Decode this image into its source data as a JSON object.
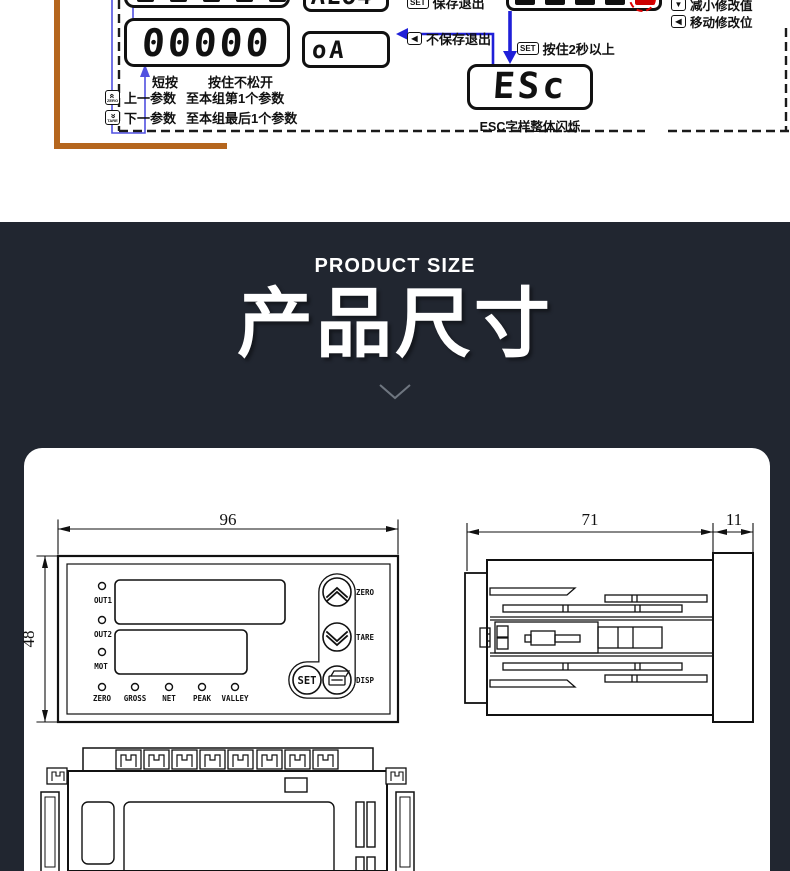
{
  "diagram": {
    "display_main": "00000",
    "display_or": "oA",
    "display_esc": "ESc",
    "display_partial_top": "ALo4",
    "set_key": "SET",
    "save_exit": "保存退出",
    "no_save_exit": "不保存退出",
    "set_hold": "按住2秒以上",
    "esc_blink_note": "ESC字样整体闪烁",
    "decrease_value": "减小修改值",
    "move_digit": "移动修改位",
    "short_press": "短按",
    "hold_press": "按住不松开",
    "prev_param": "上一参数",
    "prev_param_target": "至本组第1个参数",
    "next_param": "下一参数",
    "next_param_target": "至本组最后1个参数",
    "zero_key_label": "ZERO",
    "tare_key_label": "TARE"
  },
  "banner": {
    "subtitle": "PRODUCT SIZE",
    "title": "产品尺寸"
  },
  "drawings": {
    "front": {
      "width_dim": "96",
      "height_dim": "48",
      "leds_left": [
        "OUT1",
        "OUT2",
        "MOT"
      ],
      "leds_bottom": [
        "ZERO",
        "GROSS",
        "NET",
        "PEAK",
        "VALLEY"
      ],
      "button_set": "SET",
      "label_zero": "ZERO",
      "label_tare": "TARE",
      "label_disp": "DISP"
    },
    "side": {
      "depth_dim": "71",
      "bezel_dim": "11"
    }
  },
  "colors": {
    "banner_bg": "#212630",
    "accent_orange": "#b5661e",
    "arrow_blue": "#1f1fd8",
    "alert_red": "#dd0000"
  }
}
